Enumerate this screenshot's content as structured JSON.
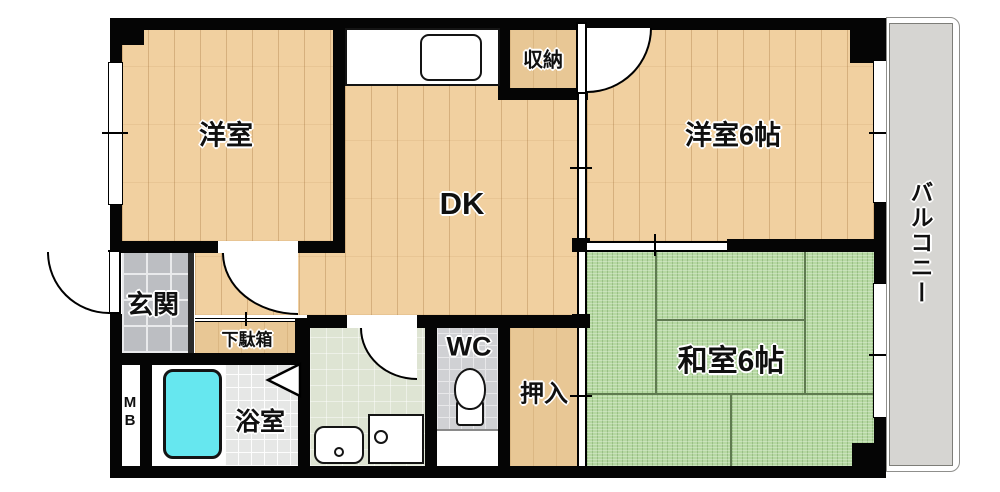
{
  "floorplan": {
    "title": "apartment-floorplan",
    "labels": {
      "yoshitsu": "洋室",
      "dk": "DK",
      "yoshitsu6": "洋室6帖",
      "washitsu6": "和室6帖",
      "shuno": "収納",
      "genkan": "玄関",
      "getabako": "下駄箱",
      "mb": "MB",
      "yokushitsu": "浴室",
      "wc": "WC",
      "oshiire": "押入",
      "balcony": "バルコニー"
    },
    "colors": {
      "wall": "#050505",
      "wood_floor": "#f1d0a0",
      "tatami": "#b6d8a2",
      "closet_floor": "#e8c795",
      "entrance_tile": "#bcbec2",
      "bath_tile": "#e6e7e6",
      "wc_tile": "#d0d1d4",
      "washroom_floor": "#dee4d3",
      "bathtub": "#66e7ef",
      "balcony": "#d6d5d2"
    }
  }
}
